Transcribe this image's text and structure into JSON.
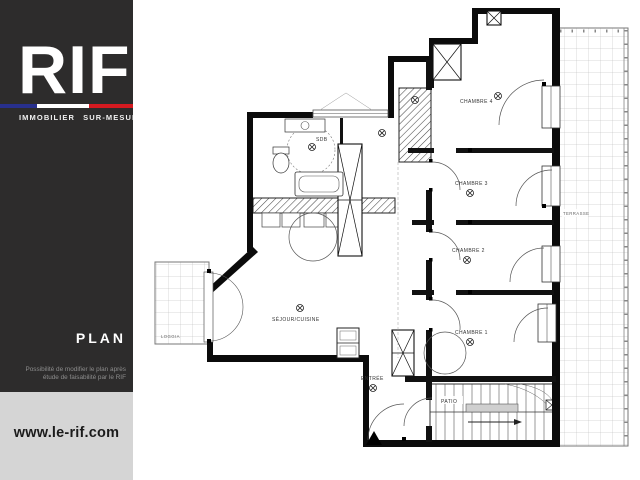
{
  "sidebar": {
    "bg_color": "#2d2c2c",
    "logo": {
      "text": "RIF",
      "tagline": "IMMOBILIER SUR-MESURE",
      "flag_colors": {
        "blue": "#28308d",
        "white": "#ffffff",
        "red": "#d41a20"
      }
    },
    "section_title": "PLAN",
    "note_line1": "Possibilité de modifier le plan après",
    "note_line2": "étude de faisabilité par le RIF",
    "website": "www.le-rif.com",
    "website_band_bg": "#d5d5d5"
  },
  "plan": {
    "labels": {
      "chambre4": "CHAMBRE 4",
      "chambre3": "CHAMBRE 3",
      "chambre2": "CHAMBRE 2",
      "chambre1": "CHAMBRE 1",
      "sdb": "SDB",
      "sejour": "SÉJOUR/CUISINE",
      "entree": "ENTRÉE",
      "loggia": "LOGGIA",
      "terrasse": "TERRASSE",
      "patio": "PATIO"
    },
    "symbols": {
      "ceiling_light": "circled-x ceiling light",
      "duct": "crossed-box duct/shaft",
      "entrance_marker": "black triangle"
    },
    "wall_color": "#0b0b0b",
    "line_color": "#444444"
  }
}
